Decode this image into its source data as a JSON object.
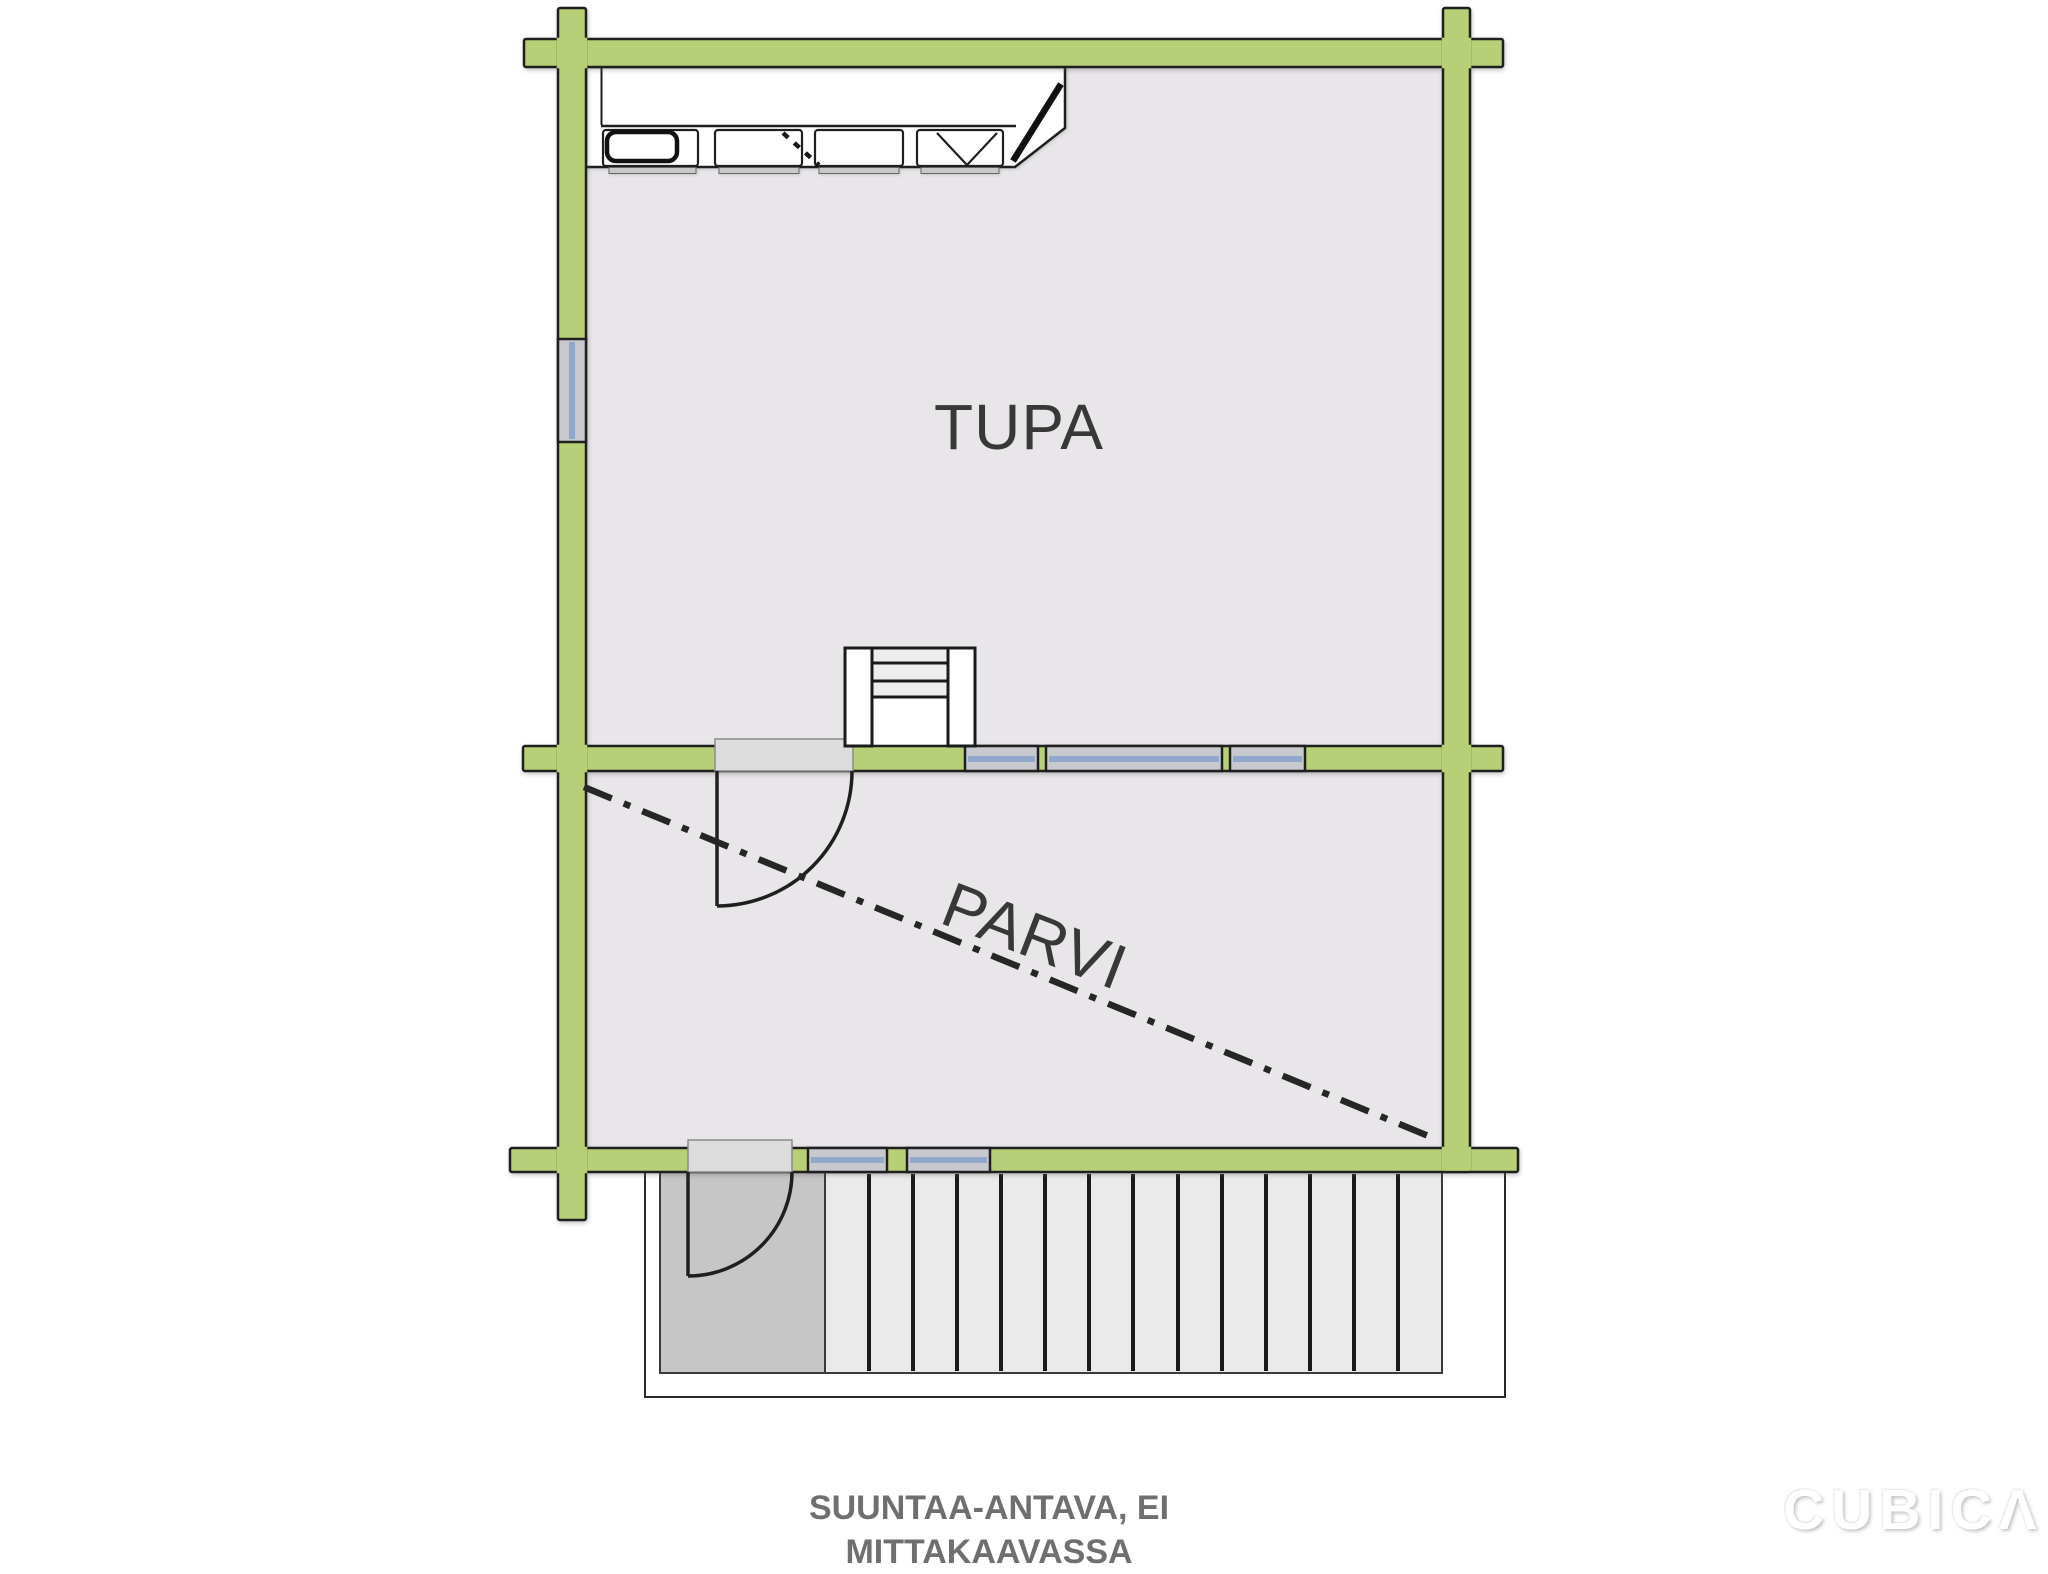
{
  "plan": {
    "rooms": [
      {
        "label": "TUPA"
      },
      {
        "label": "PARVI"
      }
    ],
    "caption": "SUUNTAA-ANTAVA, EI MITTAKAAVASSA",
    "watermark": "CUBICΛ",
    "features": {
      "kitchen_counter": "kitchen-counter-with-sink",
      "stairs": "stairs-to-loft",
      "doors": [
        "interior-door-middle-wall",
        "entrance-door-bottom-wall"
      ],
      "windows": [
        "left-wall-window",
        "middle-wall-window-1",
        "middle-wall-window-2",
        "middle-wall-window-3",
        "bottom-wall-window-1",
        "bottom-wall-window-2"
      ],
      "porch": "entrance-deck-with-boards",
      "loft_boundary": "dash-dot-diagonal-line"
    }
  },
  "colors": {
    "wall_green": "#b7d077",
    "outline": "#1f1f1f",
    "room_fill": "#e8e6e9",
    "window_glass": "#c8c9ce",
    "window_blue": "#92a7cc",
    "door_threshold": "#dcdcdc",
    "porch_landing": "#c6c6c6",
    "deck_boards": "#eaeaea",
    "stair_tread": "#ededed",
    "label_text": "#383838",
    "caption_text": "#6f6f6f"
  }
}
